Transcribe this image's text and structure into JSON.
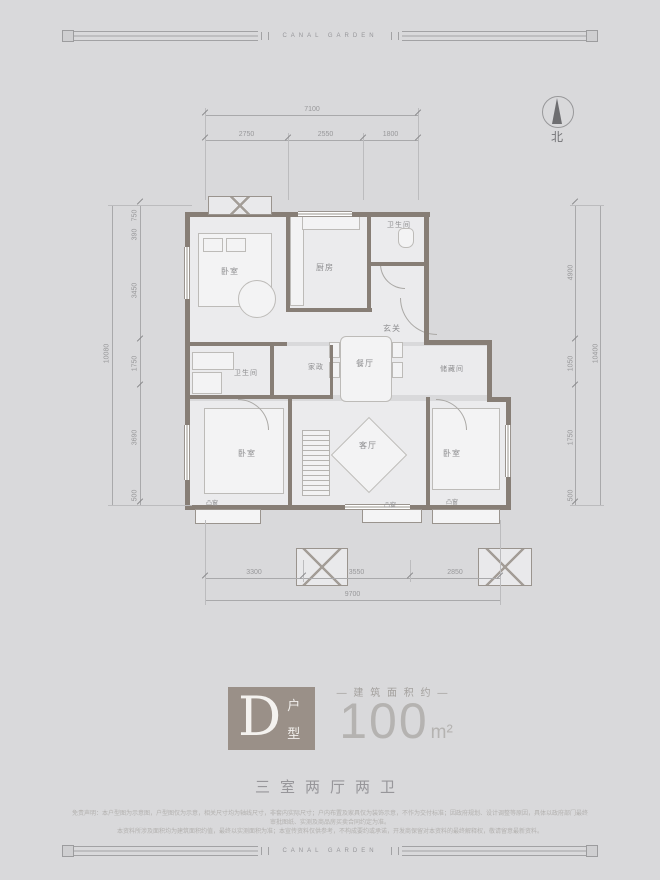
{
  "brand": {
    "top": "CANAL GARDEN",
    "bottom": "CANAL GARDEN"
  },
  "compass": {
    "north_label": "北"
  },
  "plan": {
    "rooms": {
      "bedroom_nw": "卧室",
      "kitchen": "厨房",
      "bath_n": "卫生间",
      "foyer": "玄关",
      "bath_w": "卫生间",
      "laundry": "家政",
      "dining": "餐厅",
      "storage": "储藏间",
      "bedroom_sw": "卧室",
      "living": "客厅",
      "bedroom_se": "卧室",
      "bay_a": "凸窗",
      "bay_b": "凸窗",
      "bay_c": "凸窗"
    },
    "dims": {
      "top_total": "7100",
      "top_segments": [
        "2750",
        "2550",
        "1800"
      ],
      "bottom_total": "9700",
      "bottom_segments": [
        "3300",
        "3550",
        "2850"
      ],
      "left_total": "10080",
      "left_segments": [
        "750",
        "390",
        "3450",
        "1750",
        "3690",
        "500"
      ],
      "right_total": "10400",
      "right_segments": [
        "4900",
        "1050",
        "1750",
        "500"
      ]
    }
  },
  "title_block": {
    "type_letter": "D",
    "type_suffix_1": "户",
    "type_suffix_2": "型",
    "area_label": "— 建 筑 面 积 约 —",
    "area_value": "100",
    "area_unit": "m²",
    "layout_summary": "三室两厅两卫"
  },
  "disclaimer": {
    "line1": "免责声明：本户型图为示意图，户型图仅为示意，相关尺寸均为轴线尺寸，非套内实际尺寸；户内布置及家具仅为装饰示意，不作为交付标准；因政府规划、设计调整等原因，具体以政府部门最终审批图纸、实测及商品房买卖合同约定为准。",
    "line2": "本资料所涉及面积均为建筑面积约值，最终以实测面积为准；本宣传资料仅供参考，不构成要约或承诺，开发商保留对本资料的最终解释权，敬请留意最新资料。"
  }
}
